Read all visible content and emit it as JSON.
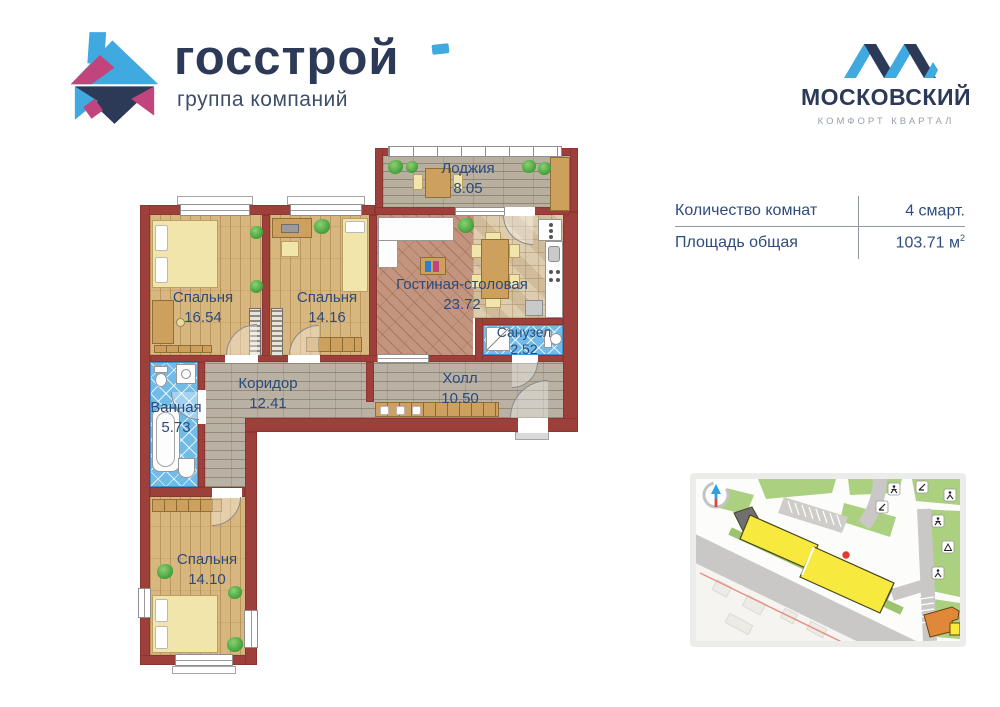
{
  "brand_left": {
    "name": "госстрой",
    "subtitle": "группа компаний"
  },
  "brand_right": {
    "name": "МОСКОВСКИЙ",
    "subtitle": "КОМФОРТ КВАРТАЛ"
  },
  "info": {
    "rows": [
      {
        "label": "Количество комнат",
        "value": "4 смарт.",
        "sup": ""
      },
      {
        "label": "Площадь общая",
        "value": "103.71 м",
        "sup": "2"
      }
    ]
  },
  "floorplan": {
    "rooms": [
      {
        "id": "loggia",
        "name": "Лоджия",
        "area": "8.05"
      },
      {
        "id": "bedroom-1",
        "name": "Спальня",
        "area": "16.54"
      },
      {
        "id": "bedroom-2",
        "name": "Спальня",
        "area": "14.16"
      },
      {
        "id": "living-dining",
        "name": "Гостиная-столовая",
        "area": "23.72"
      },
      {
        "id": "wc",
        "name": "Санузел",
        "area": "2.52"
      },
      {
        "id": "corridor",
        "name": "Коридор",
        "area": "12.41"
      },
      {
        "id": "hall",
        "name": "Холл",
        "area": "10.50"
      },
      {
        "id": "bathroom",
        "name": "Ванная",
        "area": "5.73"
      },
      {
        "id": "bedroom-3",
        "name": "Спальня",
        "area": "14.10"
      }
    ]
  },
  "colors": {
    "brand_navy": "#2c3a58",
    "brand_blue": "#3fa9e0",
    "brand_pink": "#c2447c",
    "wall": "#9d403b",
    "room_label": "#2a4b7d",
    "highlight_building": "#f7e83e"
  }
}
